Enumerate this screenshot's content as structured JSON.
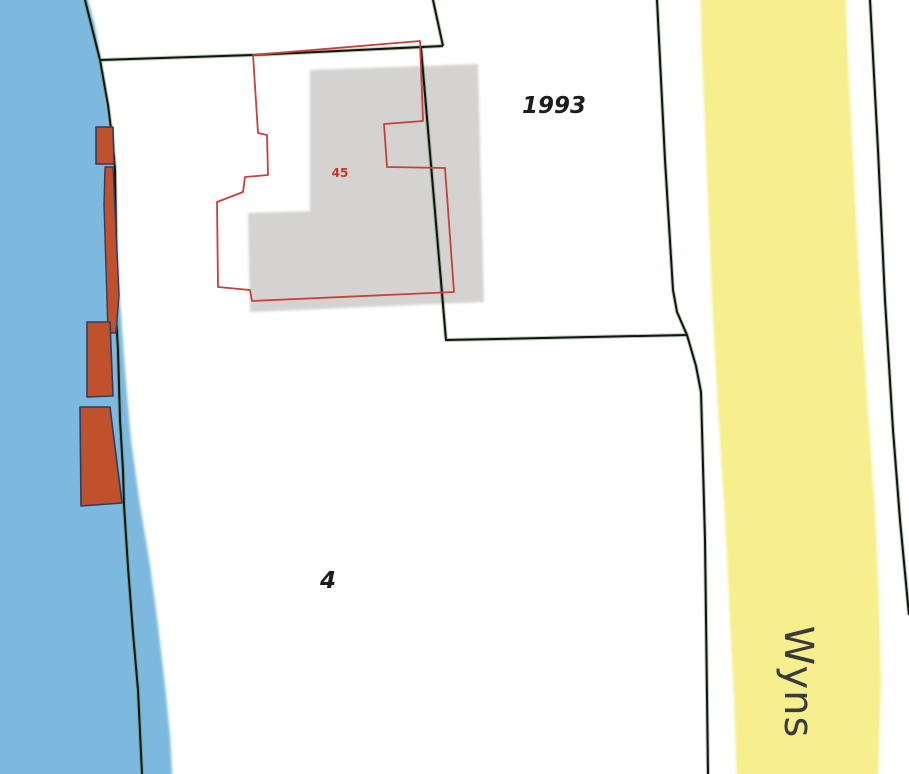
{
  "map": {
    "width": 909,
    "height": 774,
    "colors": {
      "background": "#ffffff",
      "water": "#7db9de",
      "road": "#f7ee8e",
      "buildingFill": "#c0512d",
      "buildingStroke": "#333a60",
      "footprint": "#d4d3d1",
      "outlineRed": "#c4423b",
      "boundary": "#121212",
      "casing": "#4e8c4e",
      "labelDark": "#1c1c1c",
      "labelRed": "#c0392f",
      "roadLabel": "#3a3a3a"
    },
    "features": [
      {
        "name": "water-area",
        "shape": "polygon",
        "fill": "water",
        "soft": true,
        "points": "-20,-20 88,-20 88,0 95,25 100,57 105,85 110,125 114,165 117,230 120,300 125,370 131,440 140,505 150,565 158,625 165,685 170,735 173,790 -20,790"
      },
      {
        "name": "road-area-wyns",
        "shape": "polygon",
        "fill": "road",
        "soft": true,
        "points": "700,-20 845,-20 848,60 852,140 860,290 868,410 875,510 879,600 881,680 878,790 737,790 734,700 730,620 725,520 718,410 712,300 706,150 702,60"
      },
      {
        "name": "building-footprint-gray",
        "shape": "polygon",
        "fill": "footprint",
        "soft": true,
        "points": "310,70 478,64 484,302 250,312 248,213 310,211"
      },
      {
        "name": "shore-parcel-boundary",
        "shape": "line",
        "stroke": "boundary",
        "sw": 2,
        "casing": true,
        "points": "85,0 100,60 108,105 113,145 115,170 116,240 115,300 118,350 120,420 123,470 124,505 128,567 133,633 138,690 142,774"
      },
      {
        "name": "north-parcel-boundary",
        "shape": "line",
        "stroke": "boundary",
        "sw": 2,
        "casing": true,
        "points": "100,60 253,55 443,46"
      },
      {
        "name": "northeast-corner-boundary",
        "shape": "line",
        "stroke": "boundary",
        "sw": 2,
        "casing": true,
        "points": "433,0 443,46"
      },
      {
        "name": "parcel-1993-boundary",
        "shape": "line",
        "stroke": "boundary",
        "sw": 2,
        "casing": true,
        "points": "421,48 446,340 687,335"
      },
      {
        "name": "road-west-boundary",
        "shape": "line",
        "stroke": "boundary",
        "sw": 2,
        "casing": true,
        "points": "657,0 665,160 673,290 677,312 687,335 696,366 701,392 705,540 708,774"
      },
      {
        "name": "road-east-boundary",
        "shape": "line",
        "stroke": "boundary",
        "sw": 2,
        "casing": true,
        "points": "870,0 878,150 885,300 893,430 900,520 909,615"
      },
      {
        "name": "boathouse-small",
        "shape": "polygon",
        "fill": "buildingFill",
        "stroke": "buildingStroke",
        "sw": 1.6,
        "points": "96,127 113,127 114,164 96,164"
      },
      {
        "name": "boathouse-strip",
        "shape": "polygon",
        "fill": "buildingFill",
        "stroke": "buildingStroke",
        "sw": 1.4,
        "points": "105,167 113,167 119,295 116,333 108,333 104,205"
      },
      {
        "name": "boathouse-mid",
        "shape": "polygon",
        "fill": "buildingFill",
        "stroke": "buildingStroke",
        "sw": 1.6,
        "points": "87,322 110,322 113,396 87,397"
      },
      {
        "name": "boathouse-large",
        "shape": "polygon",
        "fill": "buildingFill",
        "stroke": "buildingStroke",
        "sw": 1.6,
        "points": "80,407 110,407 122,503 81,506"
      },
      {
        "name": "parcel-45-red-outline",
        "shape": "polygon",
        "stroke": "outlineRed",
        "sw": 1.8,
        "points": "253,55 420,41 423,121 384,124 387,167 445,168 454,292 252,301 250,290 218,287 217,202 243,192 245,177 268,175 267,135 258,133"
      }
    ],
    "labels": [
      {
        "name": "parcel-label-1993",
        "text": "1993",
        "x": 554,
        "y": 113,
        "size": 23,
        "color": "labelDark",
        "italic": true,
        "weight": "600"
      },
      {
        "name": "parcel-label-4",
        "text": "4",
        "x": 328,
        "y": 588,
        "size": 23,
        "color": "labelDark",
        "italic": true,
        "weight": "600"
      },
      {
        "name": "building-label-45",
        "text": "45",
        "x": 340,
        "y": 177,
        "size": 12,
        "color": "labelRed",
        "italic": false,
        "weight": "700"
      },
      {
        "name": "road-label-wyns",
        "text": "Wyns",
        "x": 785,
        "y": 682,
        "size": 40,
        "color": "roadLabel",
        "italic": false,
        "weight": "400",
        "rotate": 90,
        "spacing": 1
      }
    ]
  }
}
